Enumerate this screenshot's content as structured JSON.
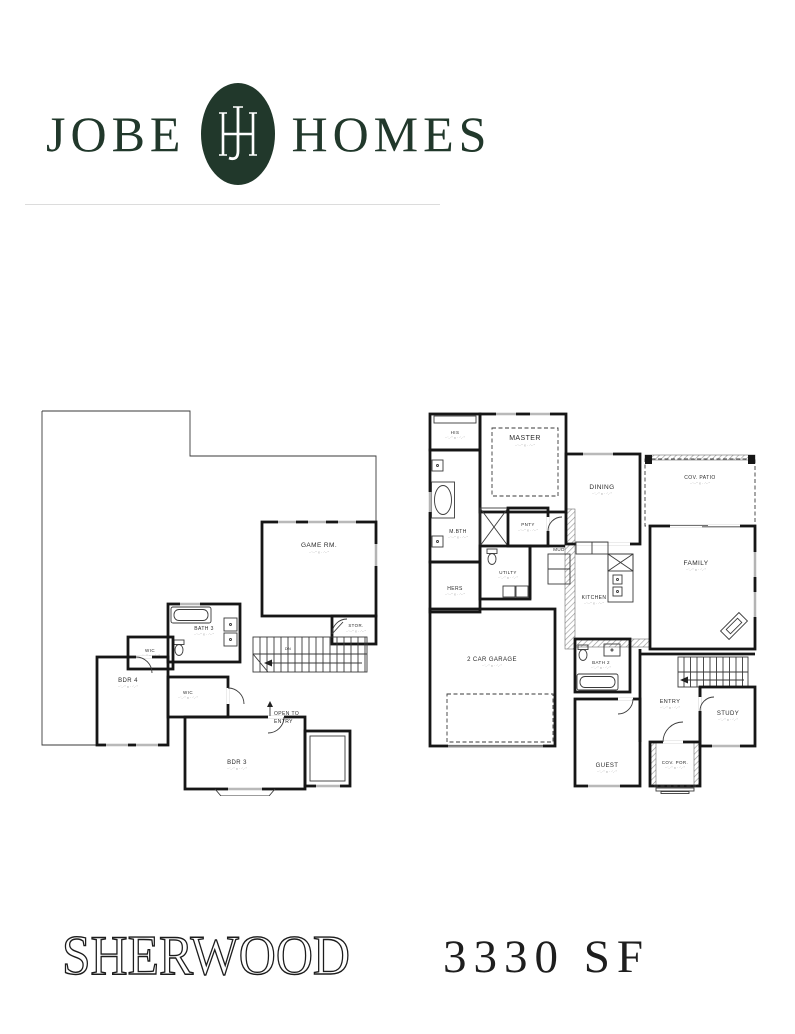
{
  "brand": {
    "name_left": "JOBE",
    "name_right": "HOMES",
    "monogram": "JH",
    "color": "#21382B"
  },
  "footer": {
    "plan_name": "SHERWOOD",
    "plan_size": "3330 SF"
  },
  "plans": {
    "dim": "··'-·\" x ··'-·\"",
    "second": {
      "rooms": {
        "game_rm": "GAME RM.",
        "stor": "STOR.",
        "bath3": "BATH 3",
        "wic_a": "WIC",
        "wic_b": "WIC",
        "bdr4": "BDR 4",
        "bdr3": "BDR 3",
        "open_line1": "OPEN TO",
        "open_line2": "ENTRY",
        "dn": "DN"
      }
    },
    "first": {
      "rooms": {
        "his": "HIS",
        "master": "MASTER",
        "mbth": "M.BTH",
        "pnty": "PNTY",
        "dining": "DINING",
        "cov_patio": "COV. PATIO",
        "family": "FAMILY",
        "utilty": "UTILTY",
        "hers": "HERS",
        "mud": "MUD",
        "kitchen": "KITCHEN",
        "garage": "2 CAR GARAGE",
        "bath2": "BATH 2",
        "entry": "ENTRY",
        "study": "STUDY",
        "guest": "GUEST",
        "cov_por": "COV. POR."
      }
    }
  }
}
